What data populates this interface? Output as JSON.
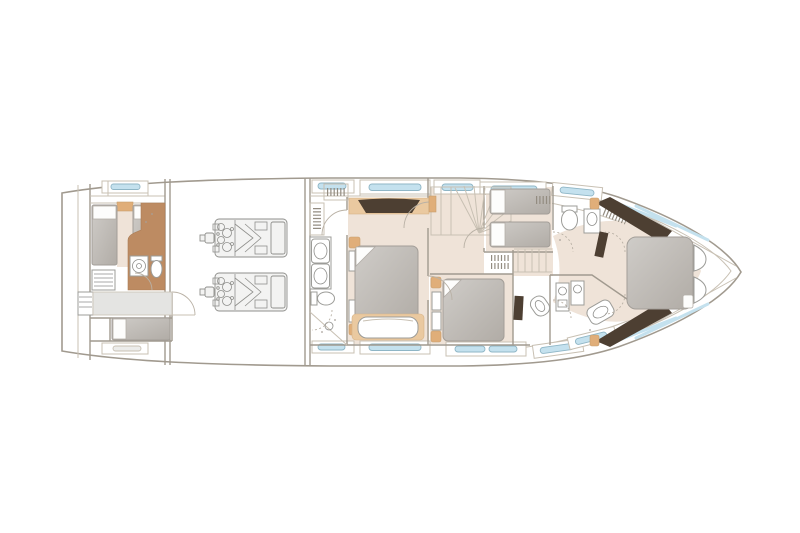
{
  "meta": {
    "title": "Yacht lower deck floor plan",
    "deck": "lower-deck",
    "orientation": "bow-right",
    "visible_text": "none"
  },
  "palette": {
    "paper": "#ffffff",
    "line": "#a19a8f",
    "line_soft": "#c8c0b3",
    "fixture": "#9c9c98",
    "floor": "#efe3d8",
    "floor_tan": "#e0ae79",
    "floor_tan_light": "#eac9a0",
    "wood": "#bd8b62",
    "wood_dark": "#4d3f32",
    "bed_light": "#cdc9c5",
    "bed_dark": "#b1aca6",
    "window_glass": "#c4e1ee",
    "window_stroke": "#8fb6c6",
    "corridor": "#e4e4e2",
    "engine_fill": "#f3f3f2",
    "engine_line": "#8f8f8c"
  },
  "rooms": [
    {
      "id": "crew-cabin",
      "name": "Crew cabin with twin berths",
      "features": [
        "two single berths",
        "drawer unit",
        "wardrobe"
      ]
    },
    {
      "id": "crew-bathroom",
      "name": "Crew bathroom",
      "features": [
        "toilet",
        "washing machine",
        "door"
      ]
    },
    {
      "id": "crew-corridor",
      "name": "Crew corridor and berth",
      "features": [
        "single berth",
        "companionway",
        "door"
      ]
    },
    {
      "id": "engine-room",
      "name": "Engine room",
      "features": [
        "port engine",
        "starboard engine"
      ]
    },
    {
      "id": "master-bathroom",
      "name": "Master bathroom",
      "features": [
        "twin sinks",
        "toilet",
        "shower",
        "wardrobe"
      ]
    },
    {
      "id": "master-cabin",
      "name": "Full-beam master cabin",
      "features": [
        "double bed",
        "headboard",
        "sofa",
        "bedside tables"
      ]
    },
    {
      "id": "staircase",
      "name": "Curved staircase to main deck",
      "features": [
        "fan treads"
      ]
    },
    {
      "id": "twin-cabin",
      "name": "Twin guest cabin",
      "features": [
        "two single beds"
      ]
    },
    {
      "id": "double-cabin",
      "name": "Double guest cabin",
      "features": [
        "double bed",
        "tv panel",
        "vanity chair"
      ]
    },
    {
      "id": "forward-bathroom-port",
      "name": "Forward bathroom (upper)",
      "features": [
        "toilet",
        "sink",
        "tv panel",
        "wardrobe"
      ]
    },
    {
      "id": "forward-bathroom-starboard",
      "name": "Forward bathroom (lower)",
      "features": [
        "two sink units",
        "shower"
      ]
    },
    {
      "id": "vip-cabin",
      "name": "VIP forward cabin",
      "features": [
        "island double bed",
        "two wardrobes",
        "bedside seats"
      ]
    }
  ],
  "equipment": {
    "engines": 2,
    "hull_windows_top": 6,
    "hull_windows_bottom": 6,
    "stern_hatch": 1
  }
}
